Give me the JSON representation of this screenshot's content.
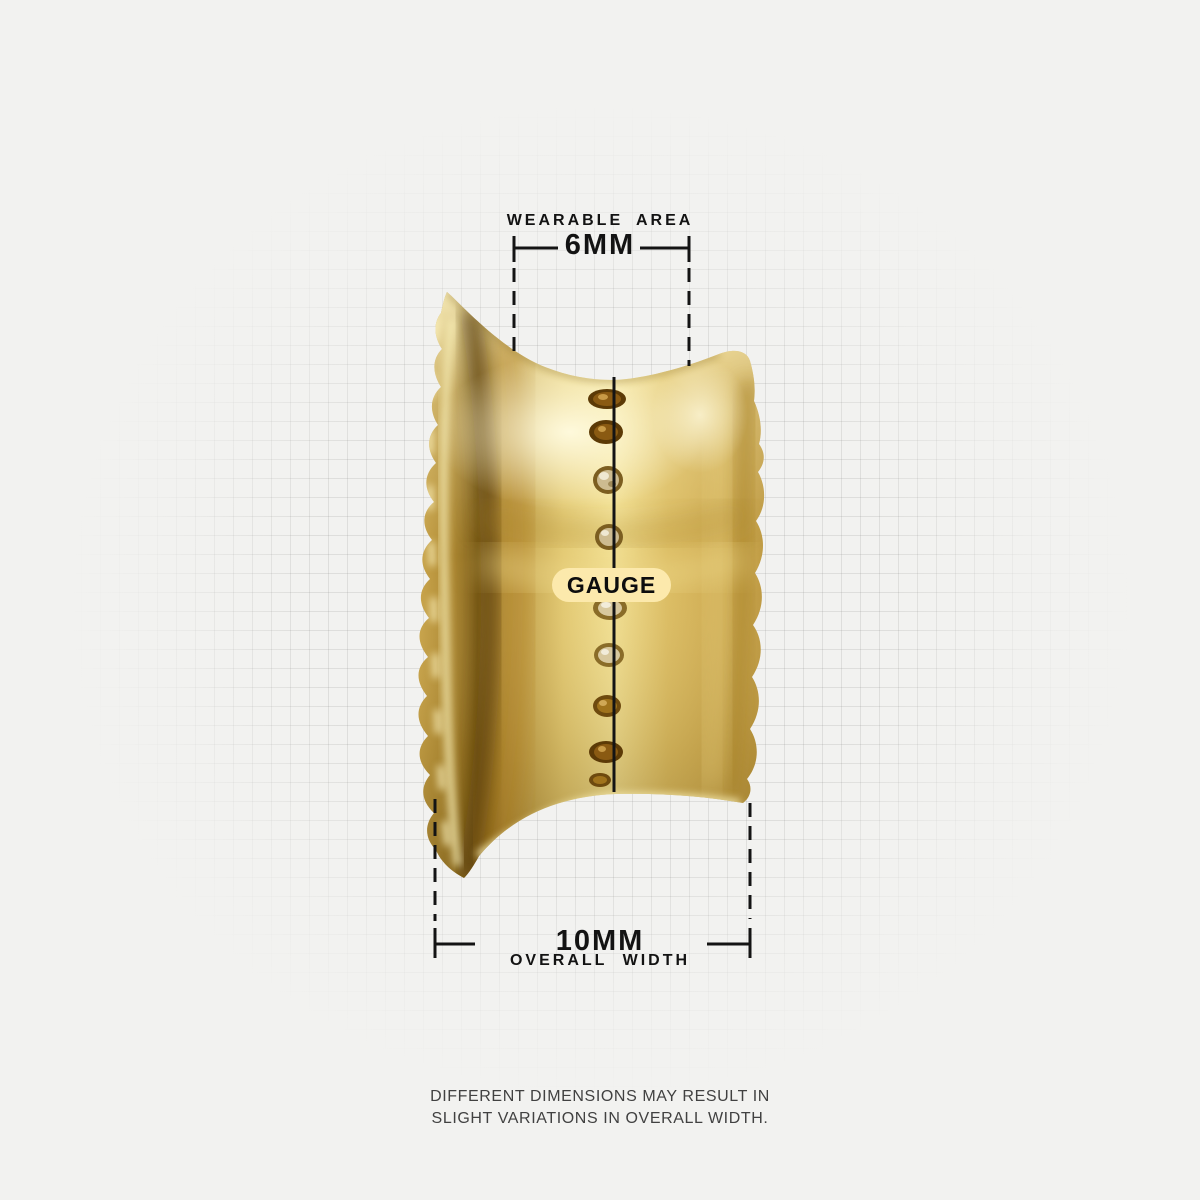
{
  "measurements": {
    "wearable_area": {
      "label": "WEARABLE AREA",
      "value": "6MM"
    },
    "overall_width": {
      "value": "10MM",
      "label": "OVERALL WIDTH"
    },
    "gauge": {
      "label": "GAUGE"
    }
  },
  "footnote": {
    "line1": "DIFFERENT DIMENSIONS MAY RESULT IN",
    "line2": "SLIGHT VARIATIONS IN OVERALL WIDTH."
  },
  "colors": {
    "background": "#f2f2f0",
    "grid_line": "#dededc",
    "measure_line": "#141414",
    "gauge_pill_bg": "#fce9ac",
    "gold_base": "#d7b862",
    "gold_highlight": "#f6e9a8",
    "gold_shadow": "#7c5c17",
    "gem_amber": "#8a5a12",
    "gem_champagne": "#cdbb90"
  }
}
